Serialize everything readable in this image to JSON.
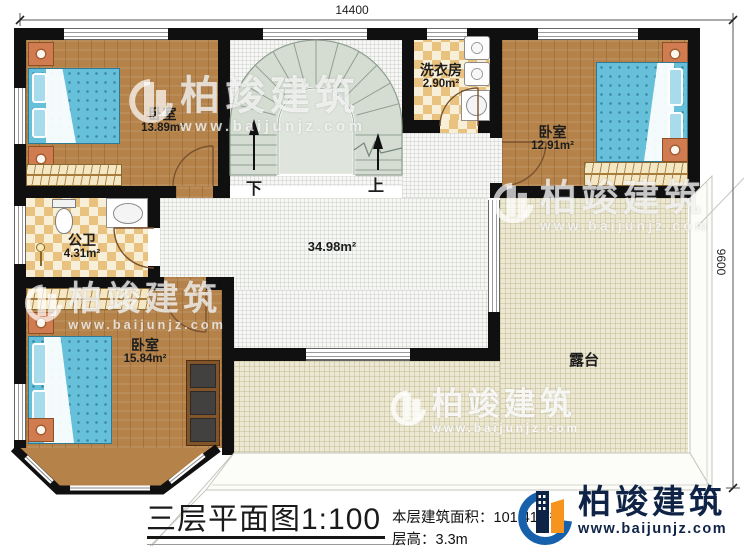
{
  "plan": {
    "dim_width": "14400",
    "dim_depth": "9600",
    "rooms": {
      "bedroom_top_left": {
        "name": "卧室",
        "area": "13.89m²"
      },
      "bedroom_top_right": {
        "name": "卧室",
        "area": "12.91m²"
      },
      "bedroom_bottom_left": {
        "name": "卧室",
        "area": "15.84m²"
      },
      "laundry": {
        "name": "洗衣房",
        "area": "2.90m²"
      },
      "bathroom": {
        "name": "公卫",
        "area": "4.31m²"
      },
      "hall": {
        "area": "34.98m²"
      },
      "terrace": {
        "name": "露台"
      }
    },
    "stair": {
      "down_label": "下",
      "up_label": "上"
    }
  },
  "title_block": {
    "title": "三层平面图1:100",
    "floor_area_label": "本层建筑面积：",
    "floor_area_value": "101.41m²",
    "floor_height_label": "层高：",
    "floor_height_value": "3.3m"
  },
  "brand": {
    "name": "柏竣建筑",
    "website": "www.baijunjz.com"
  },
  "watermark": {
    "name": "柏竣建筑",
    "website": "www.baijunjz.com"
  },
  "colors": {
    "wall": "#101010",
    "wood": "#b5834a",
    "bed_blue": "#66c0da",
    "tile": "#e9c27f",
    "terrace": "#ece8d3",
    "stair": "#d5ddd2",
    "brand_blue": "#1760ac",
    "brand_orange": "#f7941d",
    "brand_navy": "#0e2346"
  }
}
